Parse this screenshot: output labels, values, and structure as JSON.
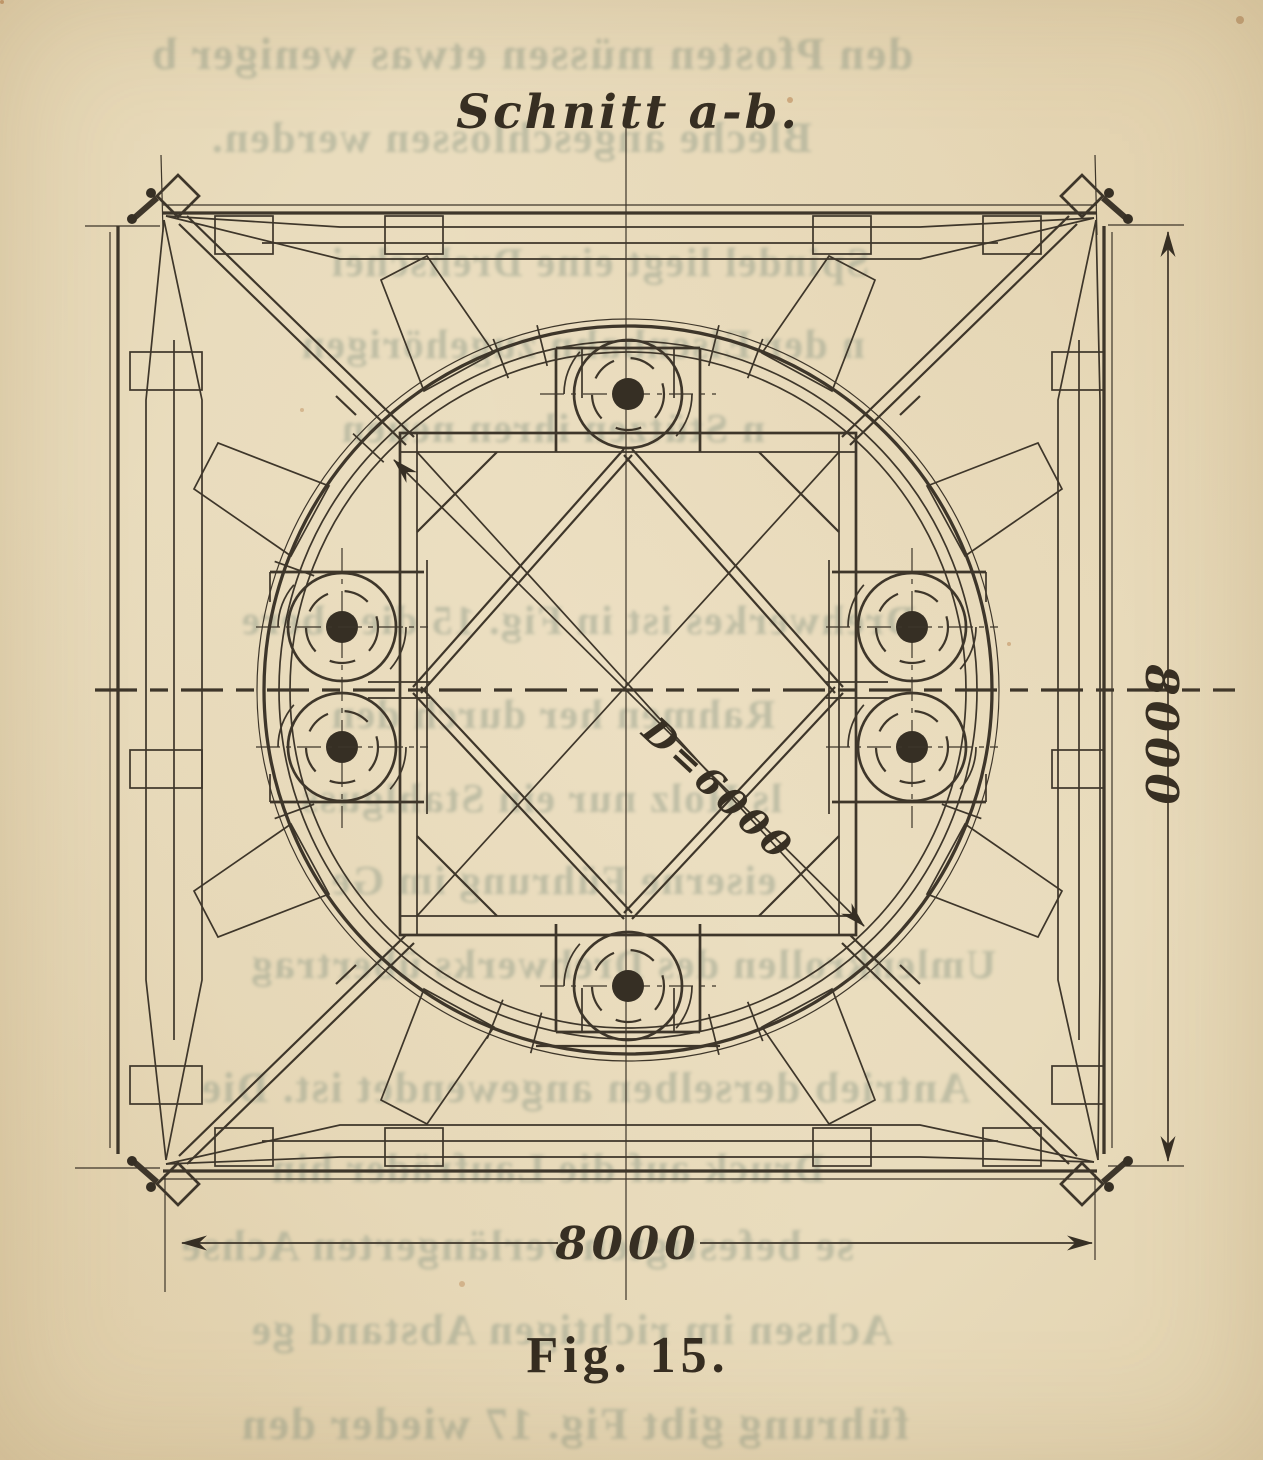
{
  "figure": {
    "title": "Schnitt a-b.",
    "caption": "Fig. 15.",
    "dimensions": {
      "right_side": "8000",
      "bottom_side": "8000",
      "diameter": "D=6000"
    },
    "colors": {
      "paper": "#e9dcbd",
      "ink": "#3e362a",
      "bleedthrough": "#96a08c"
    }
  },
  "bleedthrough": {
    "lines": [
      "den Pfosten müssen etwas weniger b",
      "Bleche angeschlossen werden.",
      "Spindel liegt eine Drehschei",
      "n der Eisenbahn zugehörigen",
      "n Stützen ihren neuen",
      "Drehwerkes ist in Fig. 15 die obere",
      "Rahmen her durch den",
      "ls Holz nur ein Stahlguss",
      "eiserne Führung im Ge",
      "Umlenkrollen des Drehwerks übertrag",
      "Antrieb derselben angewendet ist.  Die",
      "Druck auf die Laufräder hin",
      "se befestigten verlängerten Achse",
      "Achsen im richtigen Abstand ge",
      "führung gibt Fig. 17 wieder den"
    ]
  }
}
